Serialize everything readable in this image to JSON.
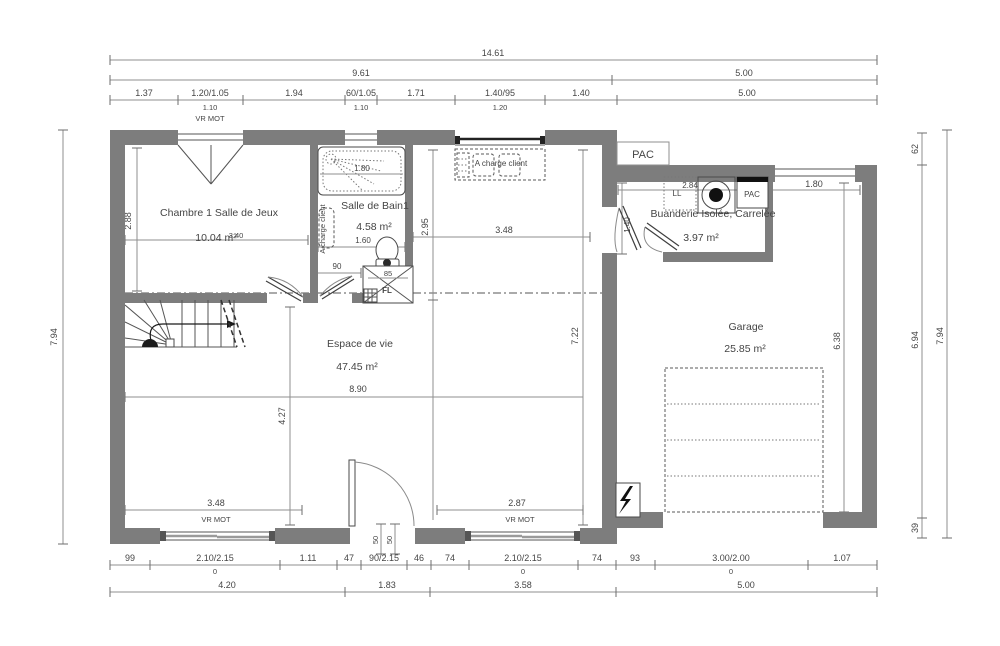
{
  "colors": {
    "wall": "#7d7d7d",
    "dim_line": "#8f8f8f",
    "text": "#454545"
  },
  "rooms": [
    {
      "name": "Chambre 1 Salle de Jeux",
      "area": "10.04 m²"
    },
    {
      "name": "Salle de Bain1",
      "area": "4.58 m²"
    },
    {
      "name": "Buanderie Isolée, Carrelée",
      "area": "3.97 m²"
    },
    {
      "name": "Espace de vie",
      "area": "47.45 m²"
    },
    {
      "name": "Garage",
      "area": "25.85 m²"
    }
  ],
  "labels": {
    "vr_mot": "VR MOT",
    "pac": "PAC",
    "ll": "LL",
    "fl": "FL",
    "a_charge_client": "A charge client"
  },
  "dims": {
    "top": {
      "overall": "14.61",
      "group_left": "9.61",
      "group_right": "5.00",
      "row": [
        "1.37",
        "1.20/1.05",
        "1.94",
        "60/1.05",
        "1.71",
        "1.40/95",
        "1.40",
        "5.00"
      ],
      "sub": [
        "1.10",
        "1.10",
        "1.20"
      ]
    },
    "bottom": {
      "row": [
        "99",
        "2.10/2.15",
        "1.11",
        "47",
        "90/2.15",
        "46",
        "74",
        "2.10/2.15",
        "74",
        "93",
        "3.00/2.00",
        "1.07"
      ],
      "sub": [
        "0",
        "0",
        "0"
      ],
      "groups": [
        "4.20",
        "1.83",
        "3.58",
        "5.00"
      ],
      "door": [
        "50",
        "50"
      ]
    },
    "left": {
      "overall": "7.94"
    },
    "right": {
      "top": "62",
      "middle": "6.94",
      "bottom": "39",
      "overall": "7.94"
    },
    "interior": {
      "chambre_height": "2.88",
      "chambre_width": "3.40",
      "tub": "1.80",
      "bath_width": "1.60",
      "bath_height": "2.95",
      "kitchen_width": "3.48",
      "hall_door": "90",
      "wc_width": "85",
      "living_width": "8.90",
      "living_height": "7.22",
      "living_left_height": "4.27",
      "window_left": "3.48",
      "window_right": "2.87",
      "buanderie_width": "2.84",
      "buanderie_door": "1.40",
      "garage_window": "1.80",
      "garage_height": "6.38"
    }
  }
}
